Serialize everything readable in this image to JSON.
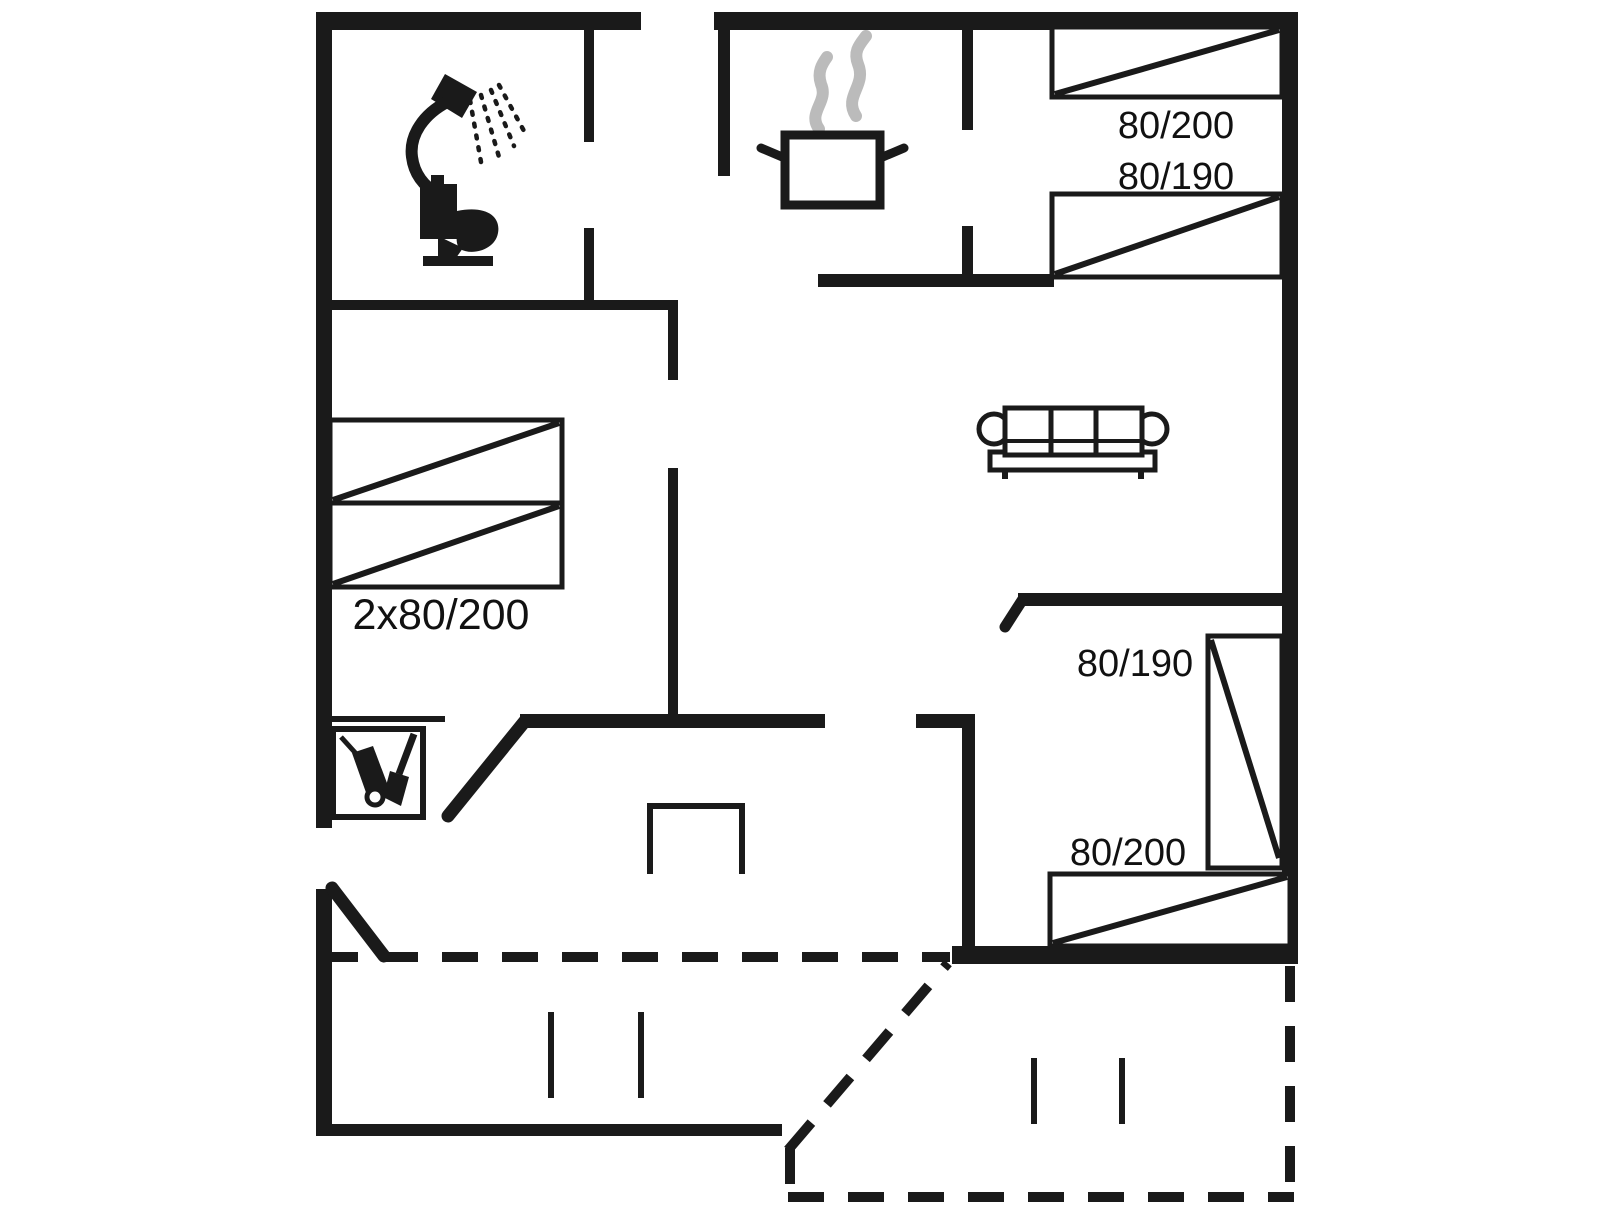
{
  "colors": {
    "background": "#ffffff",
    "lines": "#1a1a1a",
    "steam": "#bbbbbb"
  },
  "bed_labels": {
    "top_right_upper": "80/200",
    "top_right_lower": "80/190",
    "left_double": "2x80/200",
    "bottom_right_side": "80/190",
    "bottom_right_bottom": "80/200"
  },
  "icons": {
    "shower": "shower-icon",
    "toilet": "toilet-icon",
    "cooking_pot": "cooking-pot-icon",
    "steam": "steam-icon",
    "sofa": "sofa-icon",
    "cleaning_closet": "cleaning-closet-icon",
    "fireplace": "fireplace-icon"
  }
}
